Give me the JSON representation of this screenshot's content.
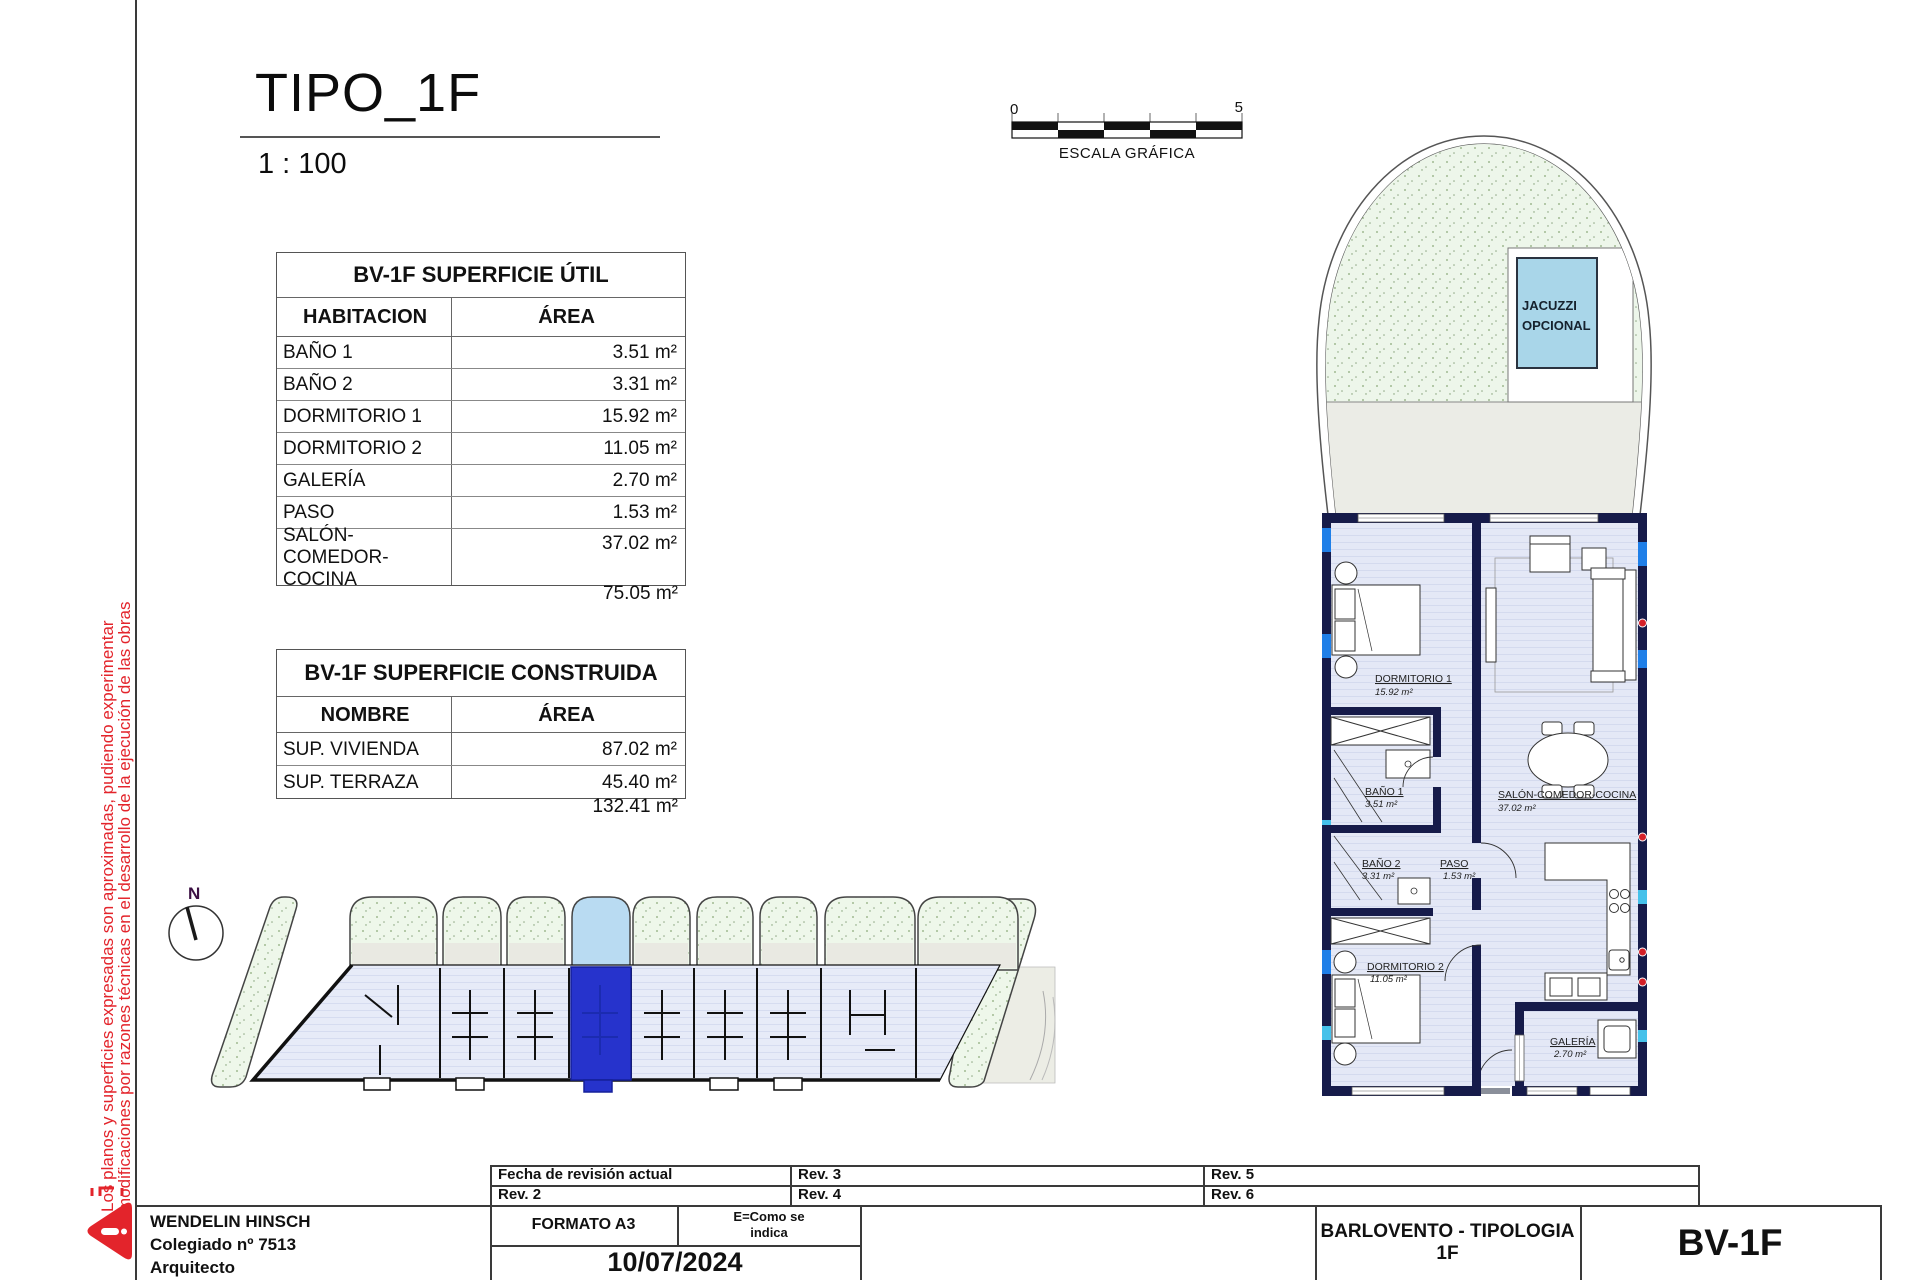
{
  "sheet": {
    "title": "TIPO_1F",
    "scale": "1 : 100",
    "disclaimer_line1": "Los planos y superficies expresadas son aproximadas, pudiendo experimentar",
    "disclaimer_line2": "modificaciones por razones técnicas en el desarrollo de la ejecución de las obras"
  },
  "scale_bar": {
    "start": "0",
    "end": "5",
    "caption": "ESCALA GRÁFICA"
  },
  "tables": {
    "util": {
      "title": "BV-1F SUPERFICIE ÚTIL",
      "col1": "HABITACION",
      "col2": "ÁREA",
      "rows": [
        {
          "name": "BAÑO 1",
          "area": "3.51 m²"
        },
        {
          "name": "BAÑO 2",
          "area": "3.31 m²"
        },
        {
          "name": "DORMITORIO 1",
          "area": "15.92 m²"
        },
        {
          "name": "DORMITORIO 2",
          "area": "11.05 m²"
        },
        {
          "name": "GALERÍA",
          "area": "2.70 m²"
        },
        {
          "name": "PASO",
          "area": "1.53 m²"
        },
        {
          "name": "SALÓN-COMEDOR-COCINA",
          "area": "37.02 m²"
        }
      ],
      "total": "75.05 m²"
    },
    "construida": {
      "title": "BV-1F SUPERFICIE CONSTRUIDA",
      "col1": "NOMBRE",
      "col2": "ÁREA",
      "rows": [
        {
          "name": "SUP. VIVIENDA",
          "area": "87.02 m²"
        },
        {
          "name": "SUP. TERRAZA",
          "area": "45.40 m²"
        }
      ],
      "total": "132.41 m²"
    }
  },
  "plan": {
    "north_label": "N",
    "jacuzzi_line1": "JACUZZI",
    "jacuzzi_line2": "OPCIONAL",
    "rooms": [
      {
        "name": "DORMITORIO 1",
        "area": "15.92 m²"
      },
      {
        "name": "BAÑO 1",
        "area": "3.51 m²"
      },
      {
        "name": "BAÑO 2",
        "area": "3.31 m²"
      },
      {
        "name": "PASO",
        "area": "1.53 m²"
      },
      {
        "name": "SALÓN-COMEDOR-COCINA",
        "area": "37.02 m²"
      },
      {
        "name": "DORMITORIO 2",
        "area": "11.05 m²"
      },
      {
        "name": "GALERÍA",
        "area": "2.70 m²"
      }
    ]
  },
  "titleblock": {
    "architect": {
      "name": "WENDELIN HINSCH",
      "line2": "Colegiado nº 7513",
      "line3": "Arquitecto"
    },
    "revisions": {
      "r1": "Fecha de revisión actual",
      "r2": "Rev. 2",
      "r3": "Rev. 3",
      "r4": "Rev. 4",
      "r5": "Rev. 5",
      "r6": "Rev. 6"
    },
    "formato": "FORMATO A3",
    "escala": "E=Como se indica",
    "fecha": "10/07/2024",
    "project": "BARLOVENTO - TIPOLOGIA 1F",
    "code": "BV-1F"
  },
  "colors": {
    "wall_navy": "#161b4a",
    "floor": "#e4e8f6",
    "window_blue": "#1f7fe8",
    "window_cyan": "#45c1ea",
    "socket_red": "#d42028",
    "grass_green": "#eef7ea",
    "terrace_gray": "#ebece6",
    "jacuzzi_blue": "#a9d6e9",
    "highlight_unit_blue": "#2633cc",
    "highlight_terrace_blue": "#b9dbf2",
    "disclaimer_red": "#e3242b",
    "north_purple": "#3c1043"
  }
}
